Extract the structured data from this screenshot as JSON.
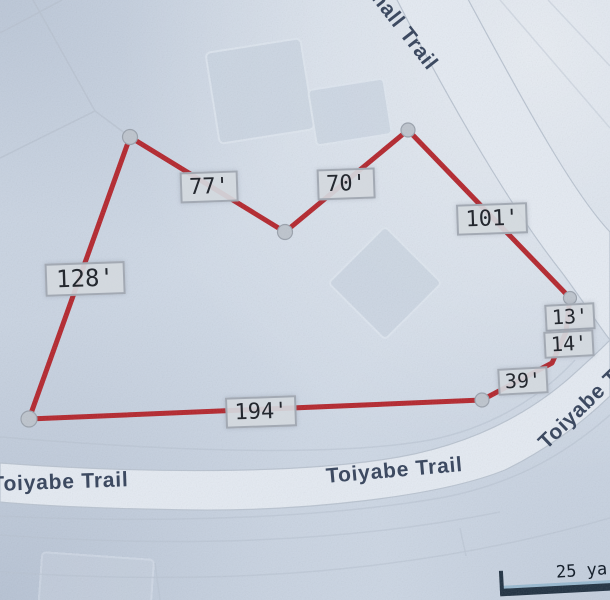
{
  "streets": {
    "top": "nall Trail",
    "bottom_left": "Toiyabe Trail",
    "bottom_center": "Toiyabe Trail",
    "right": "Toiyabe T"
  },
  "boundary": {
    "color": "#b3242b",
    "measurements": [
      {
        "side": "north-left",
        "label": "77'"
      },
      {
        "side": "north-right",
        "label": "70'"
      },
      {
        "side": "northeast",
        "label": "101'"
      },
      {
        "side": "west",
        "label": "128'"
      },
      {
        "side": "east-upper",
        "label": "13'"
      },
      {
        "side": "east-lower",
        "label": "14'"
      },
      {
        "side": "southeast",
        "label": "39'"
      },
      {
        "side": "south",
        "label": "194'"
      }
    ]
  },
  "scale_bar": {
    "label": "25 ya"
  },
  "colors": {
    "background": "#d0dae7",
    "road_fill": "#e4eaf2",
    "boundary_red": "#b3242b",
    "street_text": "#3d4a61",
    "measurement_text": "#24282f"
  }
}
